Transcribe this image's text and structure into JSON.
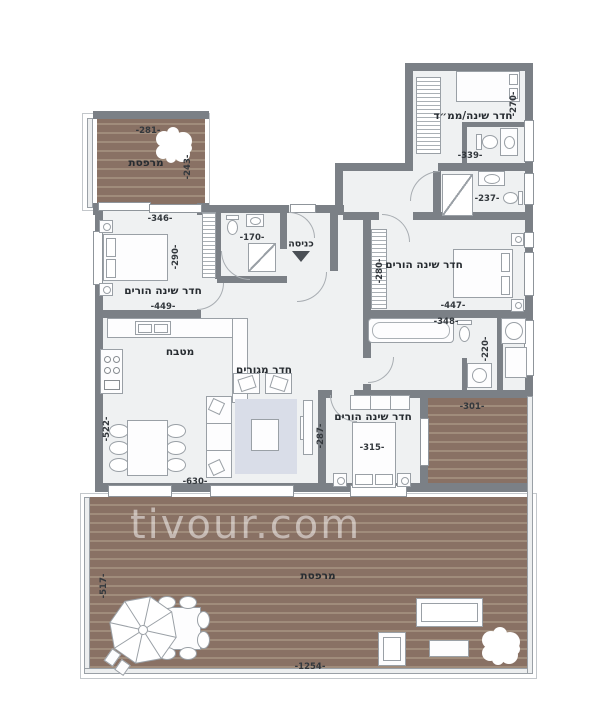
{
  "watermark": "tivour.com",
  "labels": {
    "safe_room": "חדר שינה/ממ״ד",
    "balcony_top": "מרפסת",
    "bedroom_left": "חדר שינה הורים",
    "entrance": "כניסה",
    "bedroom_right": "חדר שינה הורים",
    "kitchen": "מטבח",
    "living": "חדר מגורים",
    "bedroom_bottom": "חדר שינה הורים",
    "balcony_main": "מרפסת"
  },
  "dims": {
    "balcony_top_width": "-281-",
    "balcony_top_depth": "-243-",
    "bedroom_left_width": "-346-",
    "bedroom_left_depth": "-290-",
    "bedroom_left_width2": "-449-",
    "bath_top_width": "-170-",
    "safe_room_depth": "-270-",
    "safe_room_width": "-339-",
    "bath_right_width": "-237-",
    "bedroom_right_depth": "-280-",
    "bedroom_right_width": "-447-",
    "bath_ensuite_width": "-348-",
    "laundry_depth": "-220-",
    "deck_right_width": "-301-",
    "living_depth": "-522-",
    "living_width": "-630-",
    "living_right_depth": "-287-",
    "bedroom_bottom_width": "-315-",
    "deck_main_depth": "-517-",
    "deck_main_width": "-1254-"
  },
  "colors": {
    "wall": "#7b8086",
    "deck": "#897164",
    "deck_stripe": "#a08c7b",
    "floor": "#eff1f2",
    "rug": "#d9dde8",
    "furniture_outline": "#9aa0a6",
    "dimension_text": "#33383d",
    "watermark_color": "rgba(255,255,255,0.5)"
  }
}
